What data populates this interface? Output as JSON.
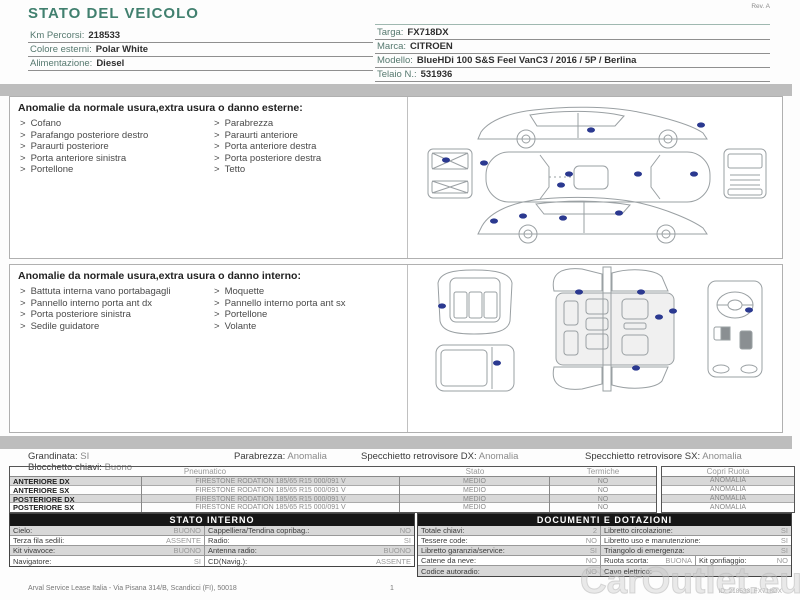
{
  "ui": {
    "bullet": ">"
  },
  "meta": {
    "revision": "Rev. A"
  },
  "header": {
    "title": "STATO DEL VEICOLO",
    "left_fields": [
      {
        "label": "Km Percorsi:",
        "value": "218533"
      },
      {
        "label": "Colore esterni:",
        "value": "Polar White"
      },
      {
        "label": "Alimentazione:",
        "value": "Diesel"
      }
    ],
    "right_fields": [
      {
        "label": "Targa:",
        "value": "FX718DX"
      },
      {
        "label": "Marca:",
        "value": "CITROEN"
      },
      {
        "label": "Modello:",
        "value": "BlueHDi 100 S&S Feel VanC3 / 2016 / 5P / Berlina"
      },
      {
        "label": "Telaio N.:",
        "value": "531936"
      },
      {
        "label": "1a imm.:",
        "value": "13/06/2019"
      }
    ]
  },
  "exterior": {
    "title": "Anomalie da normale usura,extra usura o danno esterne:",
    "col1": [
      "Cofano",
      "Parafango posteriore destro",
      "Paraurti posteriore",
      "Porta anteriore sinistra",
      "Portellone"
    ],
    "col2": [
      "Parabrezza",
      "Paraurti anteriore",
      "Porta anteriore destra",
      "Porta posteriore destra",
      "Tetto"
    ]
  },
  "interior": {
    "title": "Anomalie da normale usura,extra usura o danno interno:",
    "col1": [
      "Battuta interna vano portabagagli",
      "Pannello interno porta ant dx",
      "Porta posteriore sinistra",
      "Sedile guidatore"
    ],
    "col2": [
      "Moquette",
      "Pannello interno porta ant sx",
      "Portellone",
      "Volante"
    ]
  },
  "status_line": {
    "items": [
      {
        "label": "Grandinata:",
        "value": "SI"
      },
      {
        "label": "Blocchetto chiavi:",
        "value": "Buono"
      },
      {
        "label": "Parabrezza:",
        "value": "Anomalia"
      },
      {
        "label": "Specchietto retrovisore DX:",
        "value": "Anomalia"
      },
      {
        "label": "Specchietto retrovisore SX:",
        "value": "Anomalia"
      }
    ]
  },
  "tyres": {
    "headers": {
      "pneumatico": "Pneumatico",
      "stato": "Stato",
      "termiche": "Termiche",
      "copri_ruota": "Copri Ruota"
    },
    "rows": [
      {
        "position": "ANTERIORE DX",
        "tyre": "FIRESTONE RODATION 185/65 R15 000/091 V",
        "stato": "MEDIO",
        "termiche": "NO",
        "copri_ruota": "ANOMALIA"
      },
      {
        "position": "ANTERIORE SX",
        "tyre": "FIRESTONE RODATION 185/65 R15 000/091 V",
        "stato": "MEDIO",
        "termiche": "NO",
        "copri_ruota": "ANOMALIA"
      },
      {
        "position": "POSTERIORE DX",
        "tyre": "FIRESTONE RODATION 185/65 R15 000/091 V",
        "stato": "MEDIO",
        "termiche": "NO",
        "copri_ruota": "ANOMALIA"
      },
      {
        "position": "POSTERIORE SX",
        "tyre": "FIRESTONE RODATION 185/65 R15 000/091 V",
        "stato": "MEDIO",
        "termiche": "NO",
        "copri_ruota": "ANOMALIA"
      }
    ]
  },
  "stato_interno": {
    "title": "STATO INTERNO",
    "rows": [
      {
        "cells": [
          {
            "label": "Cielo:",
            "value": "BUONO"
          },
          {
            "label": "Cappelliera/Tendina copribag.:",
            "value": "NO"
          }
        ]
      },
      {
        "cells": [
          {
            "label": "Terza fila sedili:",
            "value": "ASSENTE"
          },
          {
            "label": "Radio:",
            "value": "SI"
          }
        ]
      },
      {
        "cells": [
          {
            "label": "Kit vivavoce:",
            "value": "BUONO"
          },
          {
            "label": "Antenna radio:",
            "value": "BUONO"
          }
        ]
      },
      {
        "cells": [
          {
            "label": "Navigatore:",
            "value": "SI"
          },
          {
            "label": "CD(Navig.):",
            "value": "ASSENTE"
          }
        ]
      }
    ]
  },
  "documenti": {
    "title": "DOCUMENTI E DOTAZIONI",
    "rows": [
      {
        "cells": [
          {
            "label": "Totale chiavi:",
            "value": "2"
          },
          {
            "label": "Libretto circolazione:",
            "value": "SI"
          }
        ]
      },
      {
        "cells": [
          {
            "label": "Tessere code:",
            "value": "NO"
          },
          {
            "label": "Libretto uso e manutenzione:",
            "value": "SI"
          }
        ]
      },
      {
        "cells": [
          {
            "label": "Libretto garanzia/service:",
            "value": "SI"
          },
          {
            "label": "Triangolo di emergenza:",
            "value": "SI"
          }
        ]
      },
      {
        "cells": [
          {
            "label": "Catene da neve:",
            "value": "NO"
          },
          {
            "label": "Ruota scorta:",
            "value": "BUONA"
          },
          {
            "label": "Kit gonfiaggio:",
            "value": "NO"
          }
        ]
      },
      {
        "cells": [
          {
            "label": "Codice autoradio:",
            "value": "NO"
          },
          {
            "label": "Cavo elettrico:",
            "value": ""
          }
        ]
      }
    ]
  },
  "footer": {
    "company": "Arval Service Lease Italia - Via Pisana 314/B, Scandicci (FI), 50018",
    "page_number": "1",
    "doc_id": "ID: 218533, FX718DX",
    "watermark": "CarOutlet.eu"
  },
  "colors": {
    "accent_teal": "#41806f",
    "bar_gray": "#bdbdbd",
    "table_header_black": "#161616",
    "damage_marker_blue": "#2b3990",
    "row_shade_gray": "#d8d8d8"
  }
}
